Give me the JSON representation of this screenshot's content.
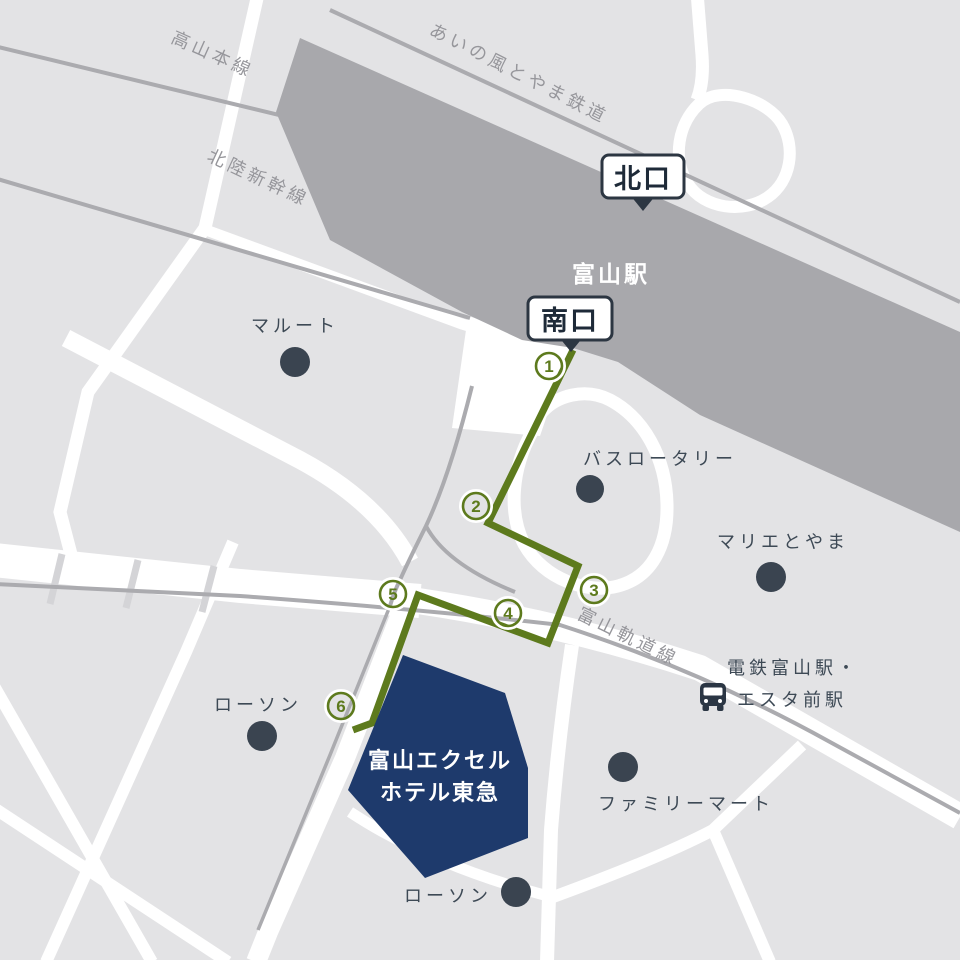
{
  "railways": {
    "takayama": "高山本線",
    "hokuriku_shinkansen": "北陸新幹線",
    "ainokaze": "あいの風とやま鉄道",
    "tram": "富山軌道線"
  },
  "station": {
    "name": "富山駅",
    "north_exit": "北口",
    "south_exit": "南口"
  },
  "route": {
    "waypoints": [
      "1",
      "2",
      "3",
      "4",
      "5",
      "6"
    ],
    "color": "#5d7a1d"
  },
  "destination": {
    "line1": "富山エクセル",
    "line2": "ホテル東急",
    "color": "#1e3a6c"
  },
  "pois": {
    "maroot": "マルート",
    "bus_rotary": "バスロータリー",
    "marier": "マリエとやま",
    "dentetsu_line1": "電鉄富山駅・",
    "dentetsu_line2": "エスタ前駅",
    "lawson_west": "ローソン",
    "lawson_south": "ローソン",
    "familymart": "ファミリーマート"
  },
  "colors": {
    "block_gray": "#e3e3e5",
    "road_white": "#ffffff",
    "station_gray": "#a8a8ac",
    "rail_gray": "#ababaf",
    "marker_slate": "#3a4450",
    "route_green": "#5d7a1d",
    "hotel_navy": "#1e3a6c",
    "badge_border": "#2c3642"
  }
}
